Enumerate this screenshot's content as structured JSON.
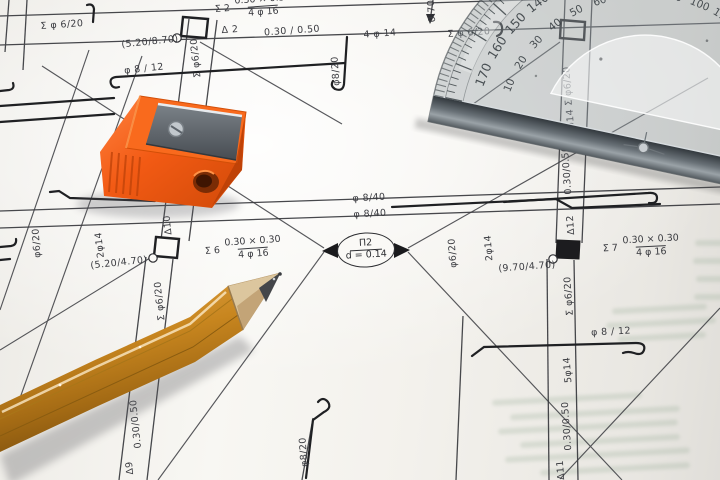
{
  "scene": {
    "type": "photograph",
    "subject": "Structural reinforcement (rebar) engineering drawing with wooden pencil, orange pencil sharpener and transparent protractor"
  },
  "drawing": {
    "labels": [
      {
        "text": "Σ φ 6/20",
        "x": 62,
        "y": 25,
        "rot": -4
      },
      {
        "text": "Δ 2",
        "x": 230,
        "y": 30,
        "rot": -4
      },
      {
        "text": "0.30 / 0.50",
        "x": 292,
        "y": 31,
        "rot": -4
      },
      {
        "text": "4 φ 14",
        "x": 380,
        "y": 34,
        "rot": -4
      },
      {
        "text": "Σ φ 6/20",
        "x": 469,
        "y": 33,
        "rot": -4
      },
      {
        "text": "(5.20/8.70)",
        "x": 150,
        "y": 42,
        "rot": -6
      },
      {
        "text": "φ 8 / 12",
        "x": 144,
        "y": 69,
        "rot": -6
      },
      {
        "text": "φ 8/40",
        "x": 369,
        "y": 198,
        "rot": -3
      },
      {
        "text": "φ 8/40",
        "x": 370,
        "y": 214,
        "rot": -3
      },
      {
        "text": "(5.20/4.70)",
        "x": 119,
        "y": 263,
        "rot": -6
      },
      {
        "text": "(9.70/4.70)",
        "x": 527,
        "y": 267,
        "rot": -4
      },
      {
        "text": "φ 8 / 12",
        "x": 611,
        "y": 332,
        "rot": -3
      },
      {
        "text": "0.70",
        "x": 432,
        "y": 11,
        "rot": -94
      },
      {
        "text": "φ8/20",
        "x": 336,
        "y": 71,
        "rot": -94
      },
      {
        "text": "Σ φ6/20",
        "x": 196,
        "y": 58,
        "rot": -96
      },
      {
        "text": "φ6/20",
        "x": 37,
        "y": 243,
        "rot": -94
      },
      {
        "text": "2φ14",
        "x": 100,
        "y": 245,
        "rot": -96
      },
      {
        "text": "Δ10",
        "x": 168,
        "y": 225,
        "rot": -96
      },
      {
        "text": "Σ φ6/20",
        "x": 160,
        "y": 301,
        "rot": -96
      },
      {
        "text": "φ6/20",
        "x": 453,
        "y": 253,
        "rot": -94
      },
      {
        "text": "2φ14",
        "x": 489,
        "y": 248,
        "rot": -94
      },
      {
        "text": "Δ12",
        "x": 571,
        "y": 225,
        "rot": -94
      },
      {
        "text": "Σ φ6/20",
        "x": 569,
        "y": 296,
        "rot": -94
      },
      {
        "text": "Σ φ6/20",
        "x": 568,
        "y": 86,
        "rot": -94
      },
      {
        "text": "5φ14",
        "x": 571,
        "y": 122,
        "rot": -94
      },
      {
        "text": "0.30/0.50",
        "x": 567,
        "y": 170,
        "rot": -94
      },
      {
        "text": "5φ14",
        "x": 568,
        "y": 370,
        "rot": -94
      },
      {
        "text": "0.30/0.50",
        "x": 567,
        "y": 426,
        "rot": -94
      },
      {
        "text": "Δ11",
        "x": 561,
        "y": 470,
        "rot": -94
      },
      {
        "text": "φ8/20",
        "x": 304,
        "y": 452,
        "rot": -94
      },
      {
        "text": "0.30/0.50",
        "x": 136,
        "y": 424,
        "rot": -96
      },
      {
        "text": "Δ9",
        "x": 130,
        "y": 468,
        "rot": -96
      }
    ],
    "fractions": [
      {
        "prefix": "Σ 2",
        "num": "0.30 × 0.30",
        "den": "4 φ 16",
        "x": 253,
        "y": 7,
        "rot": -4
      },
      {
        "prefix": "Σ 6",
        "num": "0.30 × 0.30",
        "den": "4 φ 16",
        "x": 243,
        "y": 249,
        "rot": -4
      },
      {
        "prefix": "Σ 7",
        "num": "0.30 × 0.30",
        "den": "4 φ 16",
        "x": 641,
        "y": 247,
        "rot": -3
      }
    ],
    "node": {
      "id": "Π2",
      "value": "d = 0.14"
    }
  },
  "objects": {
    "pencil": {
      "label": "wooden pencil"
    },
    "sharpener": {
      "label": "orange pencil sharpener"
    },
    "protractor": {
      "label": "transparent protractor",
      "outer_scale": [
        "10",
        "20",
        "30",
        "40",
        "50",
        "60",
        "70",
        "80",
        "90",
        "100",
        "110",
        "120",
        "130",
        "140",
        "150",
        "160",
        "170"
      ],
      "inner_scale": [
        "170",
        "160",
        "150",
        "140",
        "130",
        "120",
        "110",
        "100",
        "90",
        "80",
        "70",
        "60",
        "50",
        "40",
        "30",
        "20",
        "10"
      ]
    }
  },
  "colors": {
    "paper": "#f6f4ef",
    "ink": "#2e2f33",
    "rebar": "#1f2023",
    "pencil_body": "#c0801f",
    "sharpener_orange": "#f25a14",
    "protractor_glass": "#9aa4a8"
  }
}
